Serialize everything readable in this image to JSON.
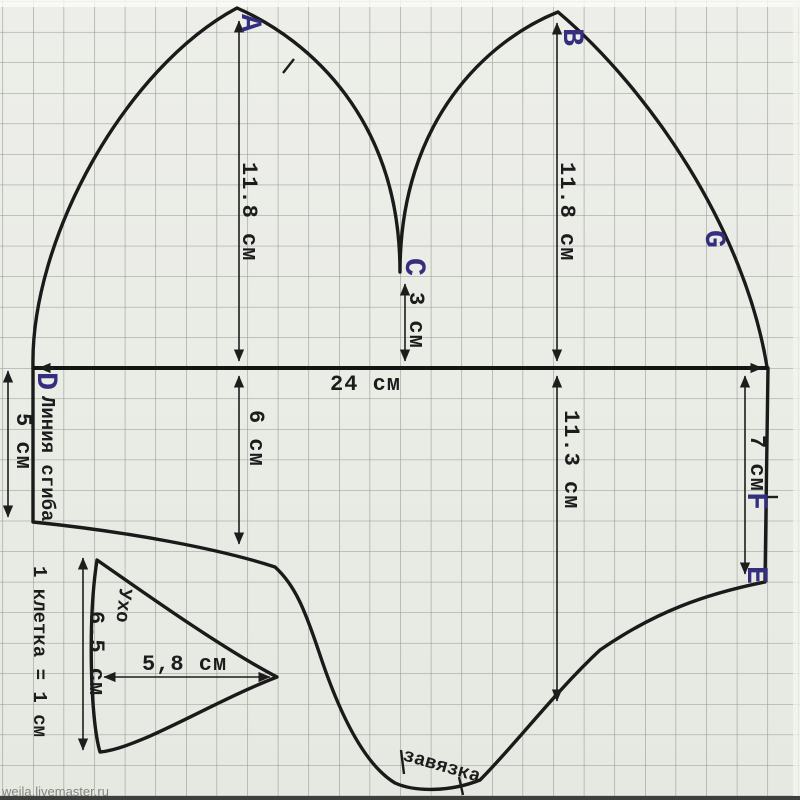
{
  "watermark": "weila.livemaster.ru",
  "scale_note": "1 клетка = 1 см",
  "points": {
    "a": "A",
    "b": "B",
    "c": "C",
    "d": "D",
    "e": "E",
    "f": "F",
    "g": "G"
  },
  "labels": {
    "fold_line": "Линия сгиба",
    "ear": "Ухо",
    "tie": "завязка"
  },
  "dims": {
    "crown_left": "11.8 см",
    "crown_right": "11.8 см",
    "notch_depth": "3 см",
    "width": "24 см",
    "front_drop": "6 см",
    "back_drop": "11.3 см",
    "right_edge": "7 см",
    "fold_edge": "5 см",
    "ear_height": "6.5 см",
    "ear_width": "5,8 см"
  },
  "colors": {
    "paper": "#e9ebe5",
    "grid": "#8b988f",
    "line": "#1a1a1a",
    "point_label": "#332e7d"
  }
}
